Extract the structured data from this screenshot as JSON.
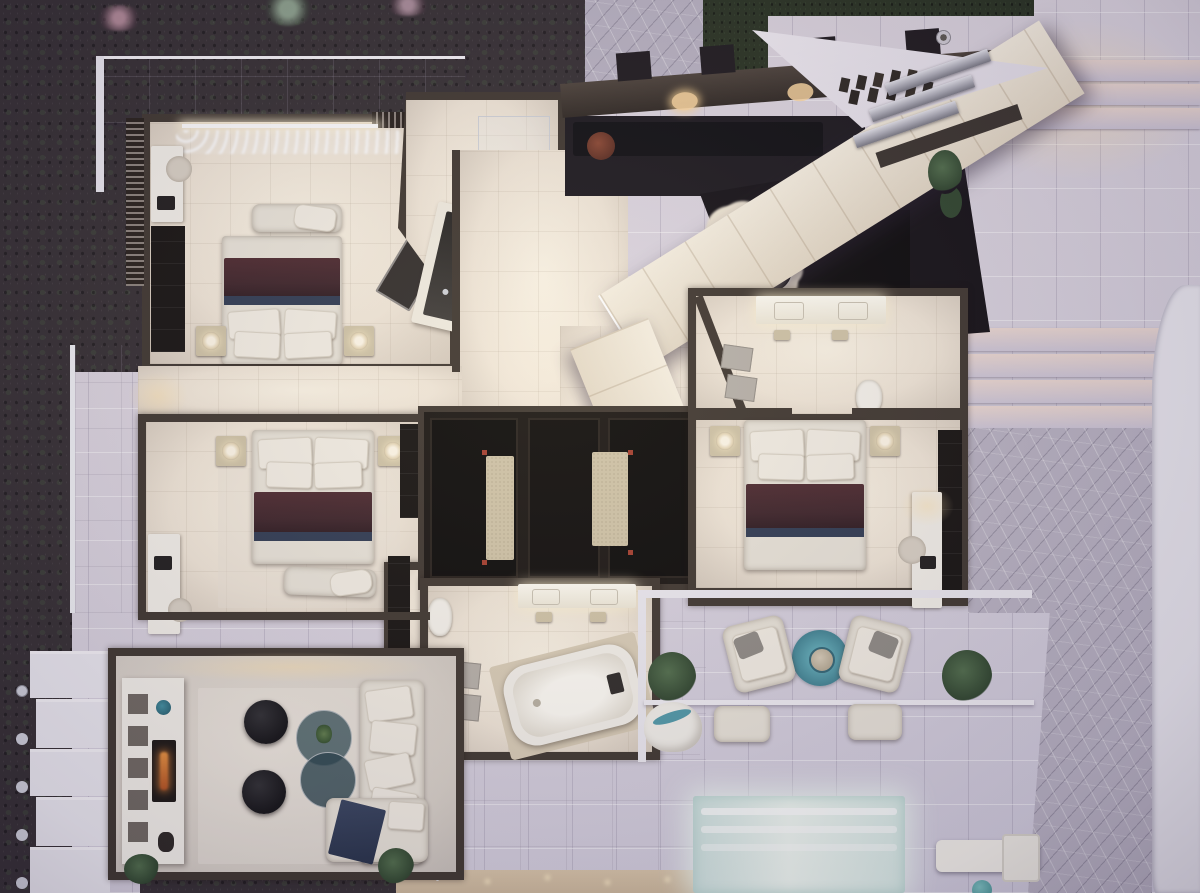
{
  "scene": {
    "type": "3d-rendered-floor-plan",
    "view": "top-down-aerial",
    "time_of_day": "dusk",
    "visible_text": "none"
  },
  "palette": {
    "grass": "#322c30",
    "hedge": "#26301f",
    "stoneTile": "#d8d4e2",
    "stoneWarm": "#ecd9d2",
    "flag": "#b9b3c3",
    "roofLav": "#e9e3ef",
    "roofLavHi": "#f4f0f7",
    "roofCream": "#efe6d4",
    "cream": "#f1e7d8",
    "creamHi": "#fbf4e5",
    "creamLo": "#d5cabc",
    "wall": "#3c342d",
    "black": "#120f0d",
    "white": "#f4f1ea",
    "beige": "#cfc3a6",
    "blanket": "#3a2026",
    "blanketDark": "#231218",
    "navy": "#2c3850",
    "teal": "#4d98a8",
    "rust": "#6e3526",
    "flame": "#cd6d2a",
    "plant": "#3a5239",
    "poolAqua": "#cfe7e4"
  },
  "rooms": [
    {
      "name": "bedroom-top-left",
      "furniture": [
        "double-bed",
        "foot-bench",
        "nightstand-pair",
        "table-lamp-pair",
        "desk",
        "desk-chair",
        "wardrobe",
        "sheer-curtains",
        "angled-console"
      ]
    },
    {
      "name": "bathroom-top-center",
      "furniture": [
        "double-vanity",
        "shower"
      ]
    },
    {
      "name": "entry-lounge-void",
      "furniture": [
        "sunken-sofa",
        "round-rust-table",
        "sphere-chandeliers",
        "skylight-boxes"
      ]
    },
    {
      "name": "walk-in-closet-center",
      "furniture": [
        "dark-cabinets",
        "runner-rug-pair"
      ]
    },
    {
      "name": "bedroom-middle-left",
      "furniture": [
        "double-bed",
        "foot-bench",
        "nightstand-pair",
        "table-lamp-pair",
        "vanity-desk",
        "wardrobe"
      ]
    },
    {
      "name": "ensuite-middle-left",
      "furniture": [
        "toilet",
        "shower-column"
      ]
    },
    {
      "name": "bathroom-center-bottom",
      "furniture": [
        "bathtub",
        "double-vanity",
        "stools",
        "toilet",
        "shower-mats",
        "potted-plant"
      ]
    },
    {
      "name": "bedroom-right",
      "furniture": [
        "double-bed",
        "nightstand-pair",
        "table-lamp-pair",
        "desk",
        "desk-chair",
        "closet-strip"
      ]
    },
    {
      "name": "ensuite-right",
      "furniture": [
        "double-vanity",
        "toilet",
        "shower-mats",
        "angled-wall"
      ]
    },
    {
      "name": "living-room-bottom-left",
      "furniture": [
        "l-shaped-sofa",
        "navy-throw",
        "round-poufs",
        "glass-coffee-tables",
        "media-console",
        "fireplace",
        "wall-niches",
        "potted-plants"
      ]
    }
  ],
  "exterior": [
    {
      "name": "lawn-top-left"
    },
    {
      "name": "flagstone-entry-path"
    },
    {
      "name": "stone-patio-right"
    },
    {
      "name": "wide-steps-top-right"
    },
    {
      "name": "wide-steps-right"
    },
    {
      "name": "flagstone-walk-bottom-right"
    },
    {
      "name": "curved-white-path-right-edge",
      "features": [
        "light-dots"
      ]
    },
    {
      "name": "roof-terrace-prow",
      "features": [
        "metal-art-set",
        "silver-stair-treads",
        "chimney-vent"
      ]
    },
    {
      "name": "diagonal-roof-band"
    },
    {
      "name": "terrace-bottom-right",
      "furniture": [
        "armchair-pair",
        "teal-round-rug",
        "side-table",
        "ottoman-pair",
        "potted-plant-pair",
        "shell-seat"
      ]
    },
    {
      "name": "pool",
      "features": [
        "underwater-glow",
        "shallow-steps"
      ]
    },
    {
      "name": "sun-lounger"
    },
    {
      "name": "teal-ball"
    },
    {
      "name": "stepped-planters-bottom-left",
      "features": [
        "post-lamps"
      ]
    },
    {
      "name": "left-deck"
    },
    {
      "name": "sand-strip-bottom",
      "features": [
        "sparkle-lights"
      ]
    }
  ]
}
